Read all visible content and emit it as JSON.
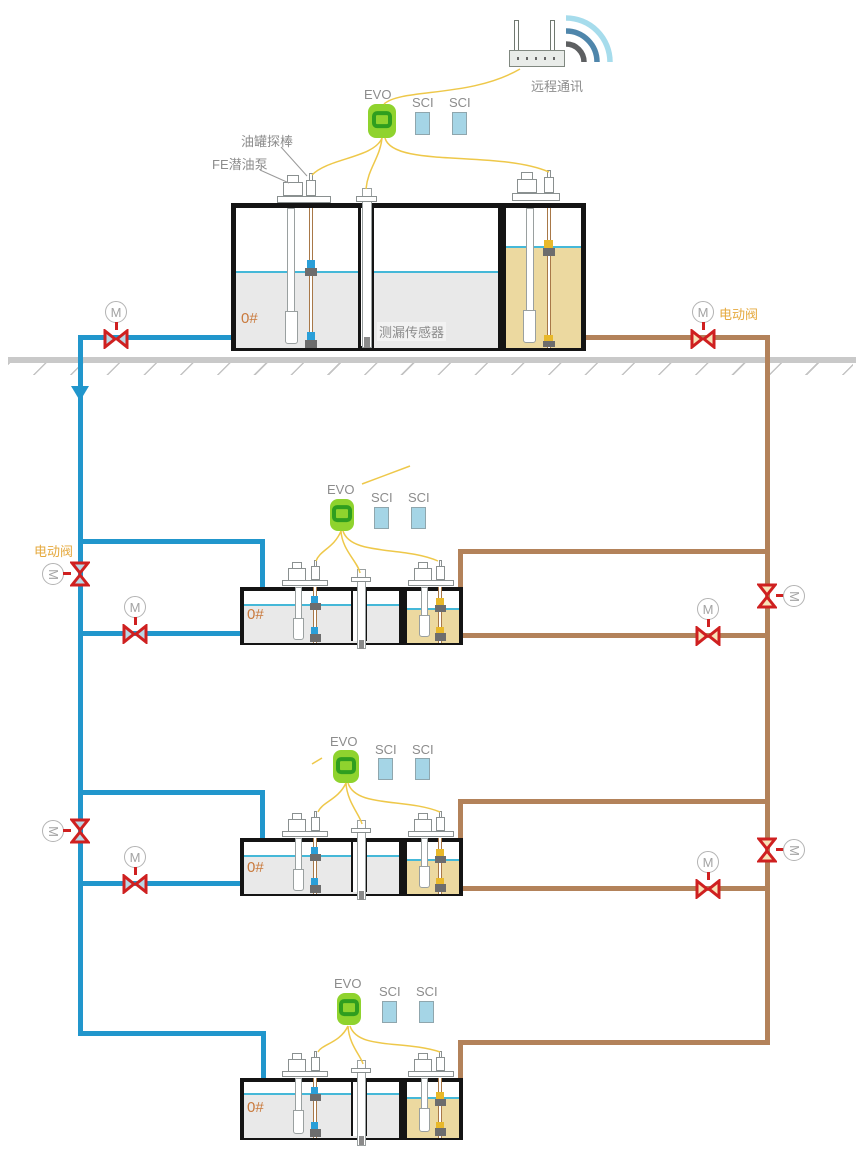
{
  "labels": {
    "remote_comm": "远程通讯",
    "tank_probe": "油罐探棒",
    "fe_pump": "FE潜油泵",
    "leak_sensor": "测漏传感器",
    "motor_valve": "电动阀",
    "motor": "M"
  },
  "devices": {
    "controller": "EVO",
    "interface_module": "SCI"
  },
  "tanks": [
    {
      "product": "0#"
    },
    {
      "product": "0#"
    },
    {
      "product": "0#"
    },
    {
      "product": "0#"
    }
  ],
  "colors": {
    "diesel_pipe_blue": "#2196cc",
    "gasoline_pipe_brown": "#b3825a",
    "valve_red": "#cf2020",
    "valve_fill_blue": "#b9d7e6",
    "valve_fill_tan": "#f7e3b8",
    "evo_green": "#8fd32e",
    "evo_ring_green": "#2f9e1f",
    "sci_blue": "#a5d5e6",
    "diesel_liquid_gray": "#e9e9e9",
    "gasoline_liquid_tan": "#ecd9a0",
    "liquid_level_cyan": "#45b8d8",
    "signal_wire_yellow": "#eec84a",
    "ground_gray": "#c9c9c9",
    "label_gray": "#8c8c8c",
    "product_orange": "#c9793c",
    "valve_label_orange": "#e5a93e"
  }
}
